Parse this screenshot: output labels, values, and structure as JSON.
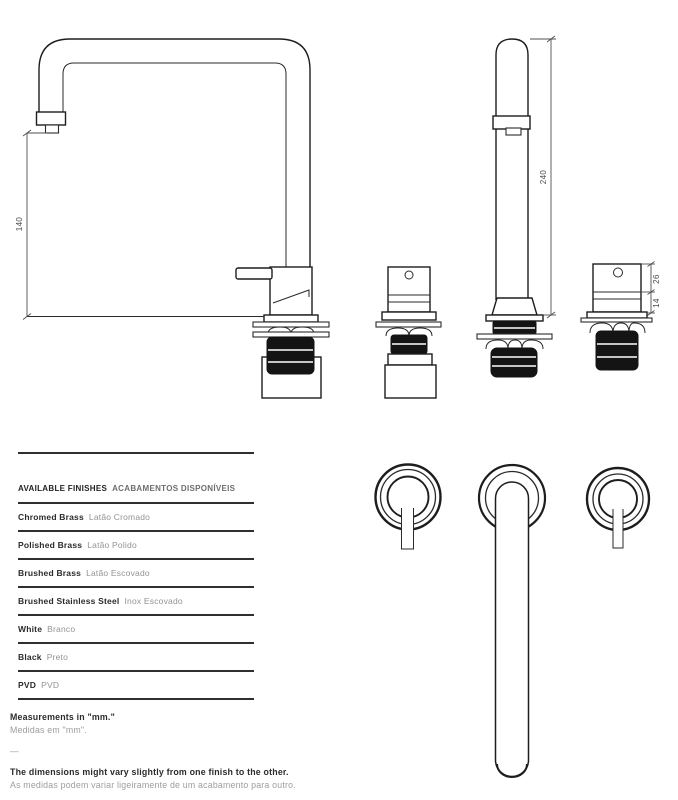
{
  "page": {
    "background": "#ffffff",
    "line_color": "#1d1d1d",
    "fill_black": "#141414",
    "dim_color": "#4a4a4a",
    "units": "mm"
  },
  "dimensions": {
    "side_view_spout_outlet_height": "140",
    "front_view_spout_height": "240",
    "valve_upper_height": "26",
    "valve_lower_height": "14"
  },
  "finishes": {
    "header_en": "AVAILABLE FINISHES",
    "header_pt": "ACABAMENTOS DISPONÍVEIS",
    "rows": [
      {
        "en": "Chromed Brass",
        "pt": "Latão Cromado"
      },
      {
        "en": "Polished Brass",
        "pt": "Latão Polido"
      },
      {
        "en": "Brushed Brass",
        "pt": "Latão Escovado"
      },
      {
        "en": "Brushed Stainless Steel",
        "pt": "Inox Escovado"
      },
      {
        "en": "White",
        "pt": "Branco"
      },
      {
        "en": "Black",
        "pt": "Preto"
      },
      {
        "en": "PVD",
        "pt": "PVD"
      }
    ]
  },
  "notes": {
    "units_en": "Measurements in \"mm.\"",
    "units_pt": "Medidas em \"mm\".",
    "divider": "—",
    "tolerance_en": "The dimensions might vary slightly from one finish to the other.",
    "tolerance_pt": "As medidas podem variar ligeiramente de um acabamento para outro."
  }
}
